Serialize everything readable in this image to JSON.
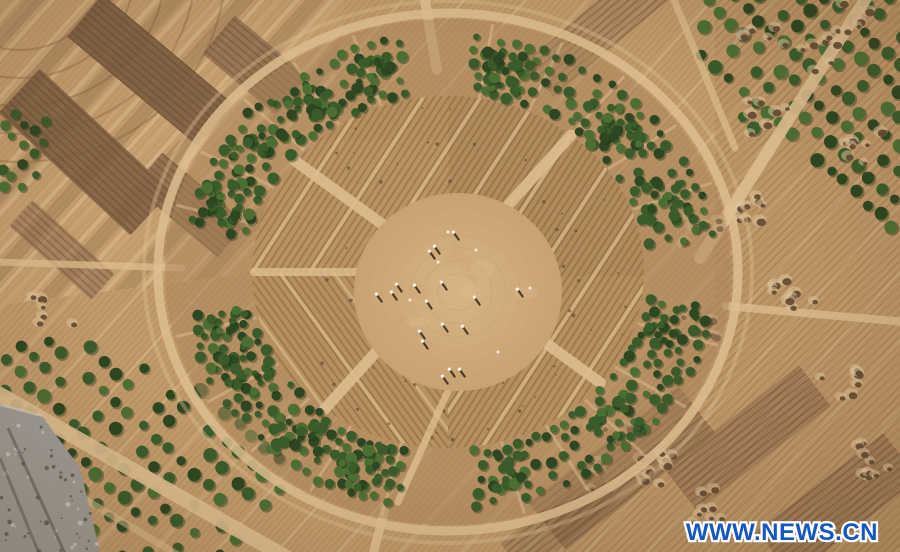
{
  "meta": {
    "alt": "Aerial drone photograph of a large circular shelter-belt ring of green trees enclosing plowed sandy farmland with a central clearing where workers stand, surrounded by furrowed desert fields, dark tilled plots, orchard rows, planting pits and dirt roads"
  },
  "watermark": {
    "text": "WWW.NEWS.CN",
    "color": "#1457bf",
    "outline_color": "#ffffff"
  },
  "palette": {
    "soilBase": "#c29b6c",
    "soilLight": "#d9b98c",
    "soilMid": "#b08a5c",
    "plotDark": "#7d5e41",
    "plotMid": "#8a684a",
    "plotSoft": "#957250",
    "furrow": "#5c3e26",
    "boundaryLight": "#e6c89b",
    "road": "#ddbe90",
    "pit": "#5e4730",
    "pitMound": "#e0c49a",
    "treeDark": "#2c4721",
    "treeMid": "#3a5c2a",
    "treeLight": "#4b6f33",
    "treeShadow": "#1f3517",
    "ringSoil": "#a9845a",
    "innerSoil": "#b7905f",
    "sandCenter": "#d8b586",
    "trackLine": "#c7a170",
    "figure": "#4e3a26",
    "figureHead": "#f5f2ea",
    "rubble": "#9e9b94",
    "rubbleDark": "#5f5c55",
    "rubbleLight": "#c9c6c0"
  },
  "scene": {
    "elements": [
      "circular-tree-ring",
      "plowed-inner-sectors",
      "central-clearing-with-workers",
      "orchard-rows-top-right",
      "orchard-rows-bottom-left",
      "dark-tilled-plots-top-left",
      "dirt-roads",
      "planting-pit-clusters",
      "gravel-patch-bottom-left"
    ]
  }
}
